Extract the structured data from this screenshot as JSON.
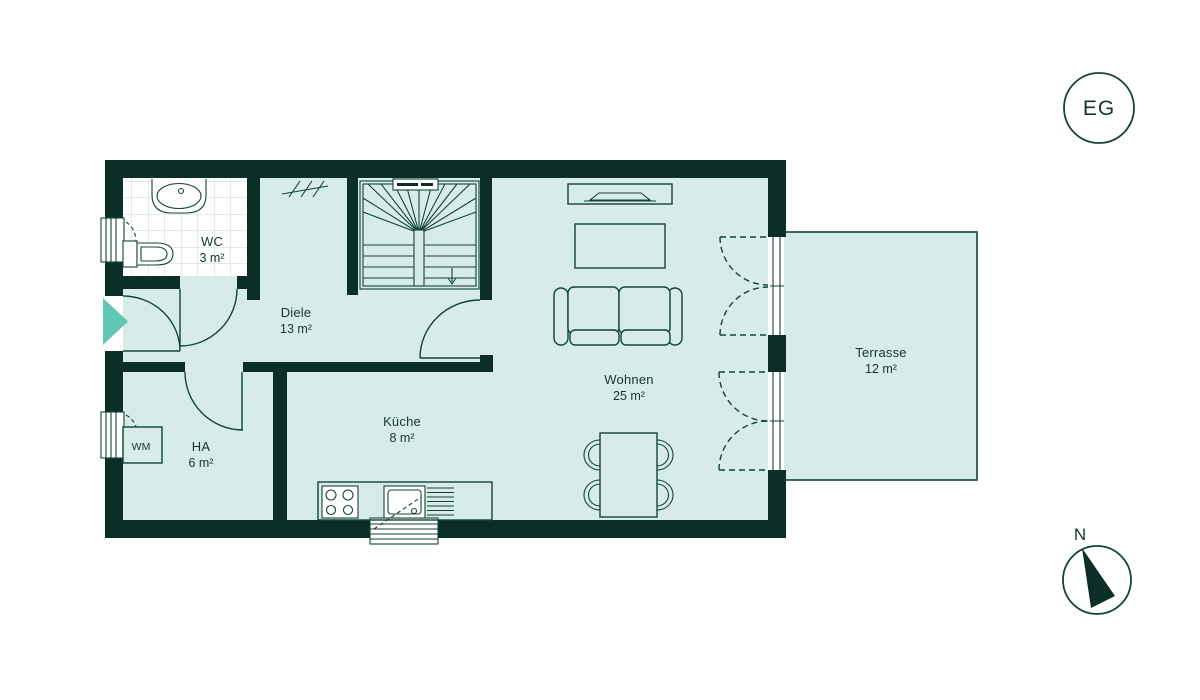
{
  "plan": {
    "badge": "EG",
    "compass_label": "N",
    "rooms": [
      {
        "id": "wc",
        "name": "WC",
        "area": "3 m²"
      },
      {
        "id": "diele",
        "name": "Diele",
        "area": "13 m²"
      },
      {
        "id": "ha",
        "name": "HA",
        "area": "6 m²"
      },
      {
        "id": "kueche",
        "name": "Küche",
        "area": "8 m²"
      },
      {
        "id": "wohnen",
        "name": "Wohnen",
        "area": "25 m²"
      },
      {
        "id": "terrasse",
        "name": "Terrasse",
        "area": "12 m²"
      }
    ],
    "appliances": {
      "wm_label": "WM"
    },
    "colors": {
      "wall": "#0b2f26",
      "floor": "#d7ece9",
      "line": "#124437",
      "accent": "#62c7b4",
      "tile": "#c7d8d4",
      "ink": "#12362c"
    }
  }
}
